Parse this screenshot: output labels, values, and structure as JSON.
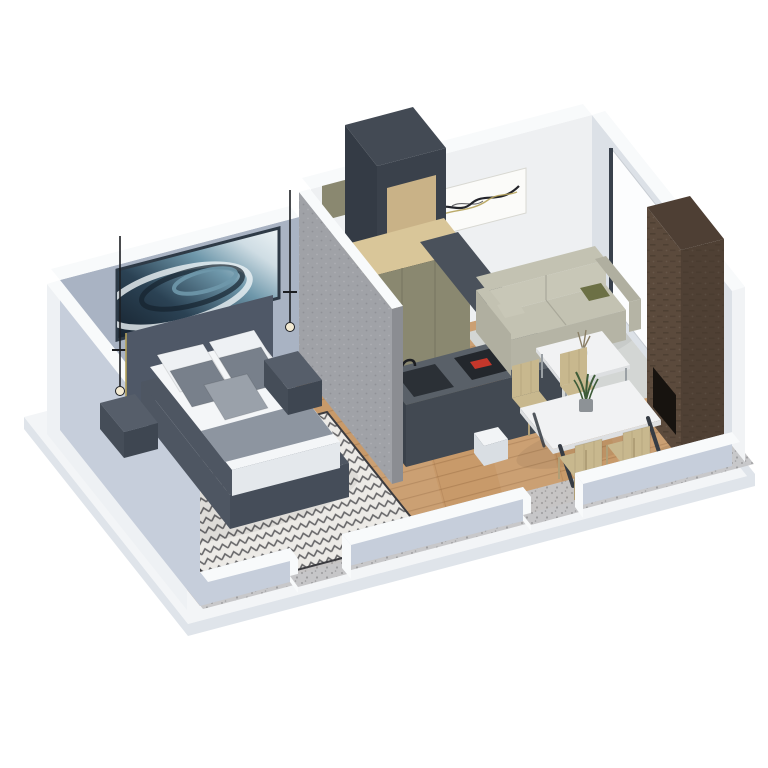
{
  "meta": {
    "description": "3D isometric cutaway floor plan rendering of a studio apartment with bedroom, bathroom, kitchen, dining area and living room",
    "background": "#ffffff"
  },
  "palette": {
    "slab": "#f3f5f7",
    "slab_side": "#dfe4ea",
    "floor_wood": "#c89a6a",
    "plank_line": "#8c5f37",
    "terrazzo": "#c6c6c8",
    "terrazzo_dot": "#9b9b9d",
    "wall_bedroom": "#a9b3c3",
    "wall_left": "#c6cedb",
    "wall_left_outer": "#eef1f4",
    "wall_top": "#f8fafb",
    "wall_white": "#eef0f2",
    "wall_right": "#dce1e7",
    "wall_right_outer": "#f1f3f5",
    "partition": "#a0a2a7",
    "partition_side": "#8b8d92",
    "art_frame": "#2e3a46",
    "canvas_white": "#fbfbf9",
    "ink": "#23242a",
    "accent_gold": "#b5a25a",
    "headboard": "#4f5867",
    "bed_frame": "#4e5662",
    "bed_frame_dark": "#454d59",
    "duvet": "#f4f6f8",
    "duvet_side": "#e4e8ec",
    "blanket": "#8d95a0",
    "pillow_white": "#eef1f4",
    "pillow_gray": "#78808b",
    "pillow_light": "#9aa1aa",
    "nightstand_top": "#565e6a",
    "nightstand_left": "#454d58",
    "nightstand_front": "#3e4651",
    "cord": "#1c1e22",
    "bulb": "#f3ead2",
    "kitchen_top": "#434a54",
    "kitchen_left": "#343b45",
    "kitchen_front": "#3a414b",
    "wood_panel": "#c9b287",
    "appliance": "#15181c",
    "olive_front": "#8a8870",
    "olive_left": "#77755f",
    "wood_top": "#d9c699",
    "counter_top": "#596068",
    "counter_left": "#3a414a",
    "counter_front": "#424952",
    "sink": "#2b3036",
    "cooktop": "#23272c",
    "cooktop_red": "#c4372b",
    "hood": "#4a515b",
    "hood_edge": "#3c434d",
    "sofa_top": "#c3c2b2",
    "sofa_seat": "#c8c7b7",
    "sofa_front": "#b5b4a5",
    "sofa_arm": "#b0afa0",
    "pillow_olive": "#6c7045",
    "rug_living": "#d3d6d4",
    "rug_bed": "#eceae6",
    "rug_pattern": "#3b3b3f",
    "marble": "#f1f2f3",
    "marble_edge": "#dddfe1",
    "table_leg": "#363c44",
    "chair_wood": "#c8b88e",
    "chair_leg": "#b09f77",
    "plant_green": "#3e5c38",
    "pot": "#8d9296",
    "vase": "#c9d2d5",
    "sprig": "#8a7f66",
    "fireplace_left": "#5b4a3c",
    "fireplace_front": "#4f4034",
    "fireplace_top": "#4e3f34",
    "firebox": "#17130f",
    "brick_shadow": "#3a2f26",
    "door_white": "#fcfdfe",
    "door_frame": "#39414c",
    "stub_top": "#f2f4f6",
    "stub_front": "#d9dee3",
    "speckle_light": "#ffffff",
    "speckle_dark": "#000000",
    "art_grad_dark": "#16222e",
    "art_grad_mid": "#2b4254",
    "art_grad_teal": "#6f98ab",
    "art_grad_pale": "#cfdde4",
    "art_grad_white": "#eef4f6"
  },
  "scene": {
    "rooms": [
      {
        "name": "bedroom",
        "items": [
          "double-bed",
          "headboard",
          "nightstand-left",
          "nightstand-right",
          "pendant-lamp-left",
          "pendant-lamp-right",
          "abstract-wall-art",
          "patterned-rug"
        ]
      },
      {
        "name": "bathroom",
        "items": [
          "concrete-partition-wall"
        ]
      },
      {
        "name": "kitchen",
        "items": [
          "tall-appliance-unit",
          "olive-cabinet-row",
          "counter-with-sink",
          "induction-cooktop",
          "hood-shelf"
        ]
      },
      {
        "name": "dining-area",
        "items": [
          "marble-dining-table",
          "potted-plant",
          "wood-chair-1",
          "wood-chair-2",
          "wood-chair-3",
          "wood-chair-4"
        ]
      },
      {
        "name": "living-room",
        "items": [
          "sofa",
          "olive-throw-pillow",
          "marble-coffee-table",
          "vase",
          "area-rug",
          "brick-fireplace-column",
          "wall-artwork",
          "entrance-door"
        ]
      }
    ]
  }
}
